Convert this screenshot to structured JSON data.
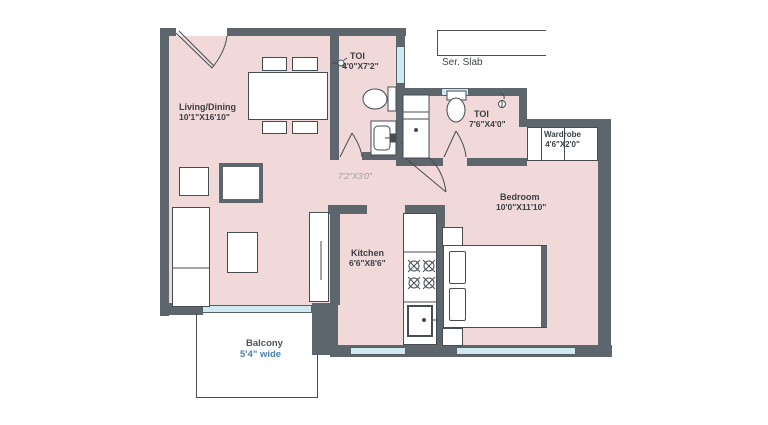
{
  "plan_type": "apartment-floor-plan",
  "rooms": {
    "living": {
      "name": "Living/Dining",
      "dims": "10'1\"X16'10\""
    },
    "toilet1": {
      "name": "TOI",
      "dims": "4'0\"X7'2\""
    },
    "service_slab": {
      "name": "Ser. Slab"
    },
    "toilet2": {
      "name": "TOI",
      "dims": "7'6\"X4'0\""
    },
    "wardrobe": {
      "name": "Wardrobe",
      "dims": "4'6\"X2'0\""
    },
    "bedroom": {
      "name": "Bedroom",
      "dims": "10'0\"X11'10\""
    },
    "passage": {
      "dims": "7'2\"X3'0\""
    },
    "kitchen": {
      "name": "Kitchen",
      "dims": "6'6\"X8'6\""
    },
    "balcony": {
      "name": "Balcony",
      "dims": "5'4\" wide"
    }
  },
  "colors": {
    "wall": "#5d666d",
    "floor": "#f1d9d9",
    "glazing": "#cfe9ee",
    "outline": "#454c52",
    "label_text": "#3a4045",
    "muted_dim_text": "#9aa0a6",
    "balcony_dim_text": "#4a7fae"
  }
}
